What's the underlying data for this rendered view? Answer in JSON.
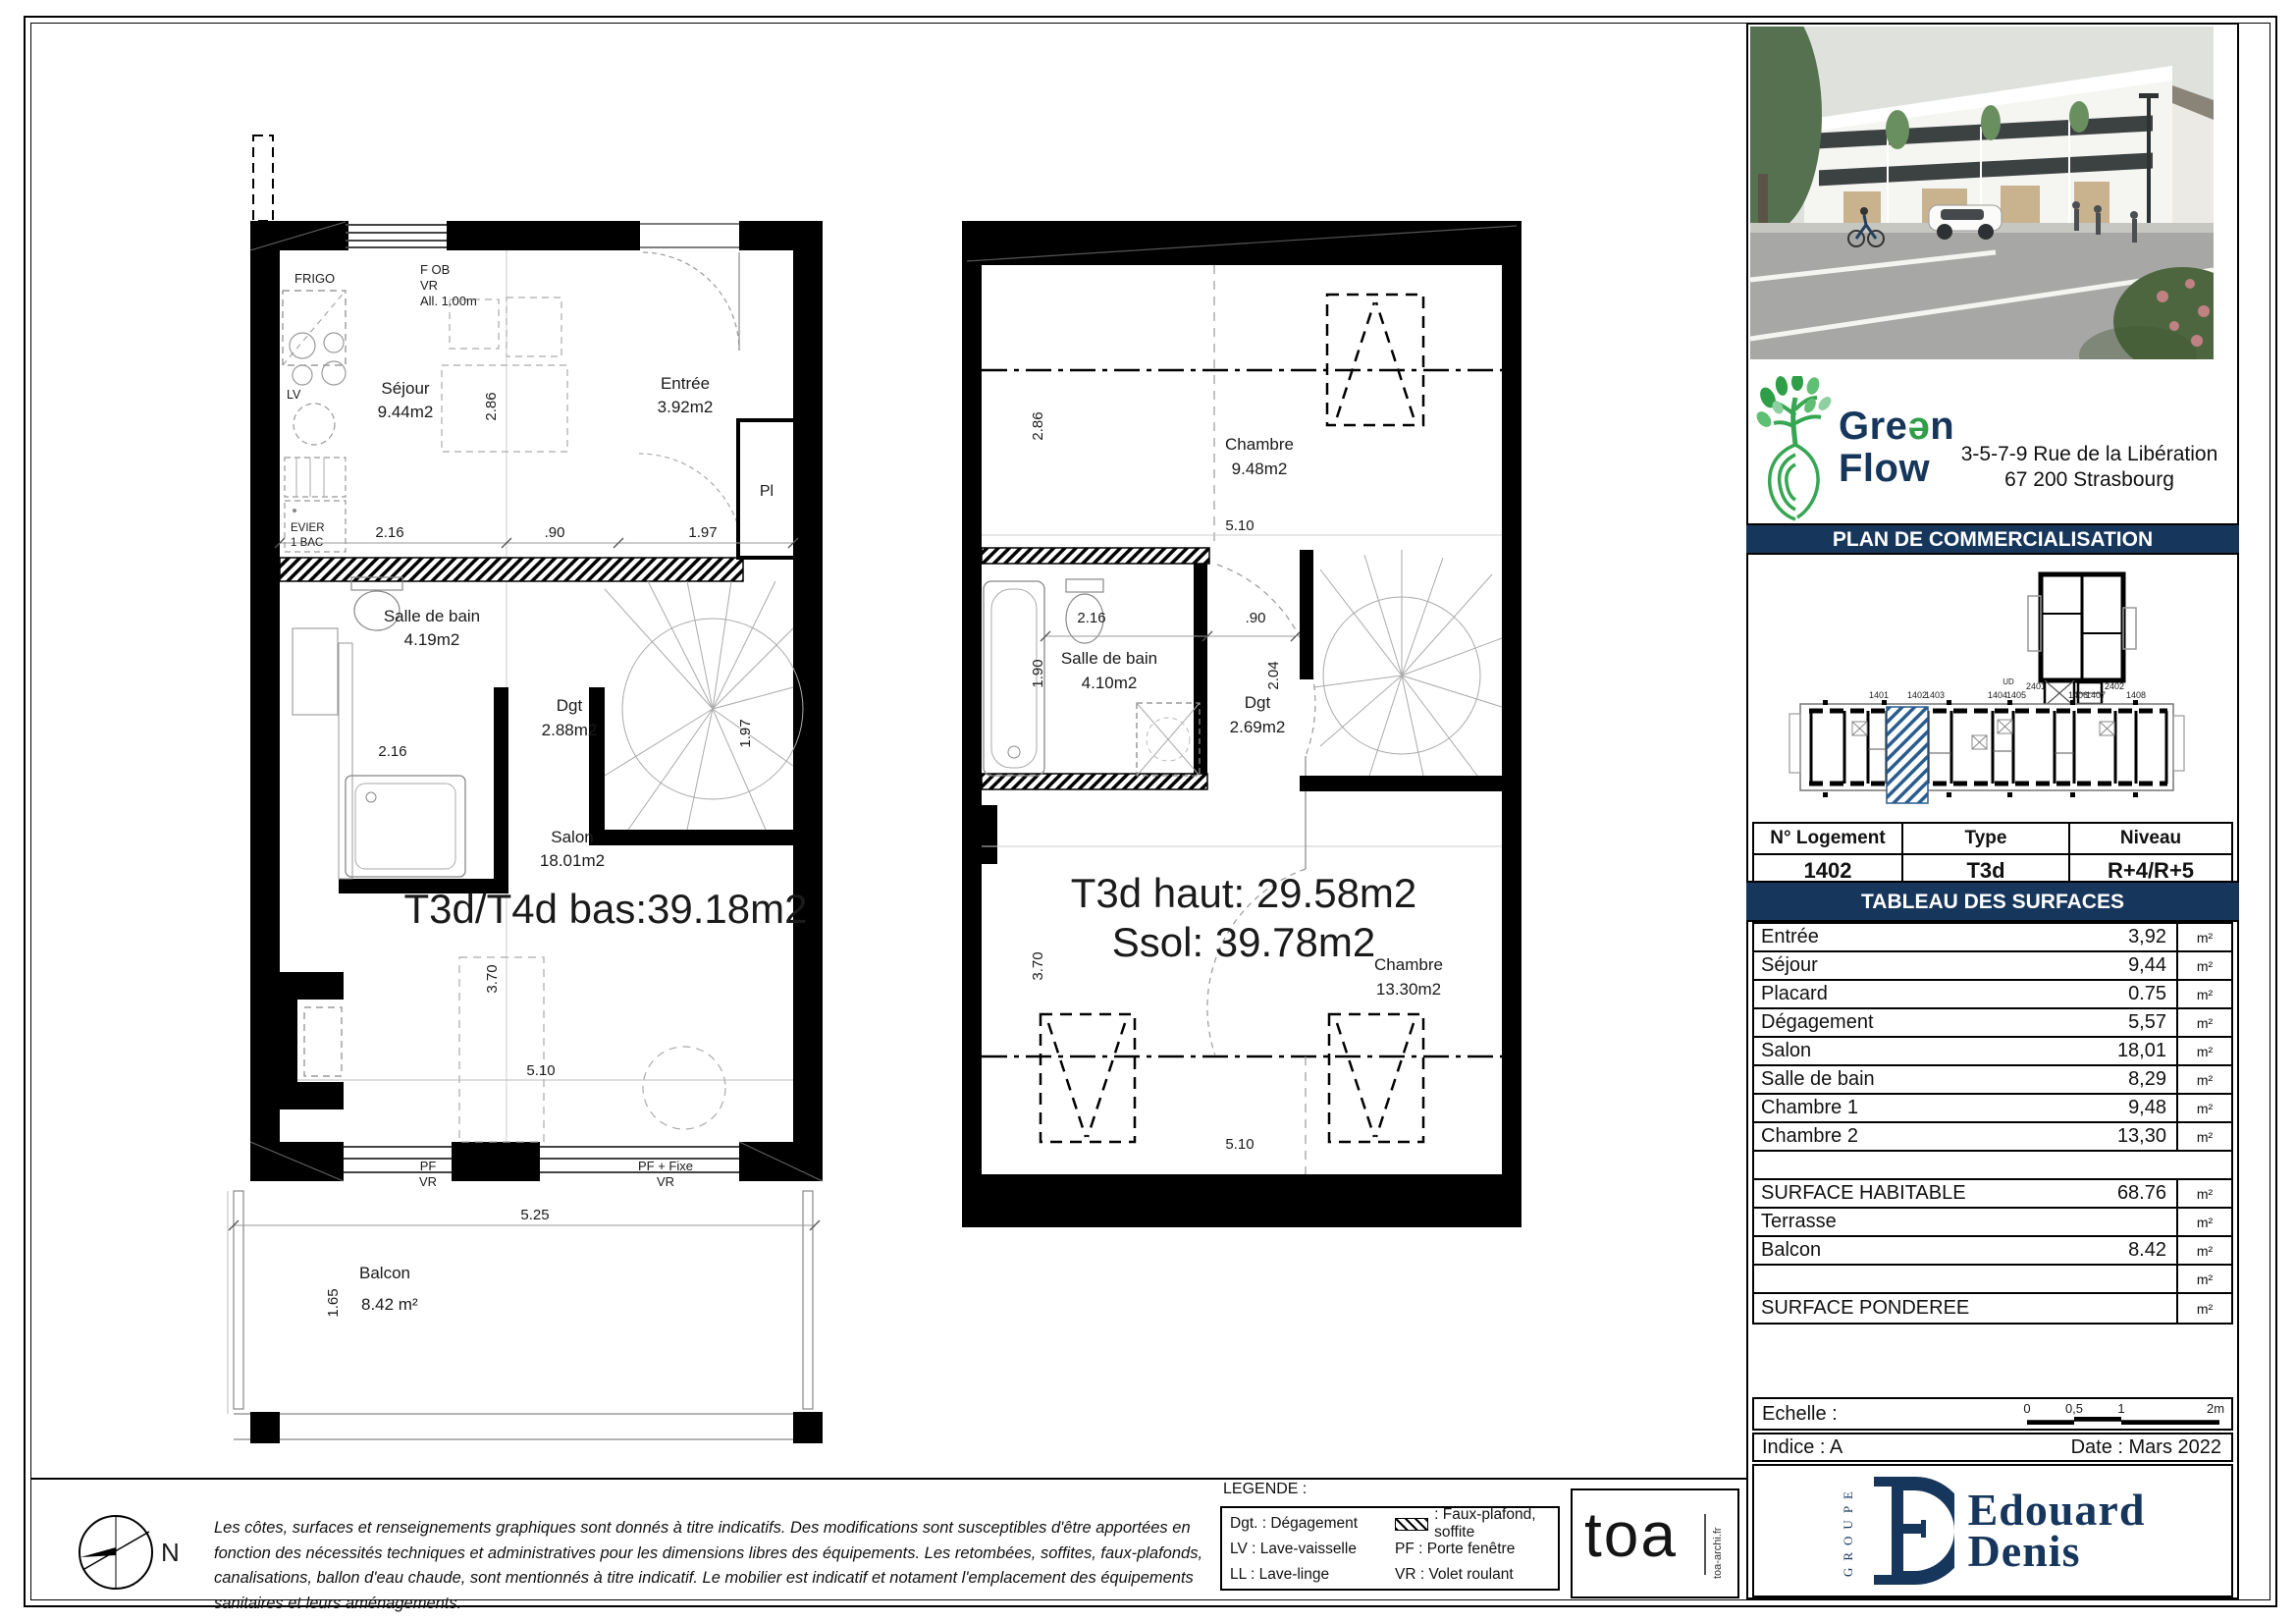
{
  "page": {
    "title": "PLAN DE COMMERCIALISATION"
  },
  "plans": {
    "left": {
      "title": "T3d/T4d bas:39.18m2",
      "labels": {
        "frigo": "FRIGO",
        "fob1": "F OB",
        "fob2": "VR",
        "fob3": "All. 1.00m",
        "sejour": "Séjour",
        "sejour_area": "9.44m2",
        "entree": "Entrée",
        "entree_area": "3.92m2",
        "pl": "Pl",
        "lv": "LV",
        "evier1": "EVIER",
        "evier2": "1 BAC",
        "sdb": "Salle de bain",
        "sdb_area": "4.19m2",
        "dgt": "Dgt",
        "dgt_area": "2.88m2",
        "salon": "Salon",
        "salon_area": "18.01m2",
        "pf1": "PF",
        "pf2": "VR",
        "pffixe1": "PF + Fixe",
        "pffixe2": "VR",
        "balcon": "Balcon",
        "balcon_area": "8.42 m²"
      },
      "dims": {
        "d286": "2.86",
        "d216a": "2.16",
        "d90": ".90",
        "d197a": "1.97",
        "d197b": "1.97",
        "d216b": "2.16",
        "d370": "3.70",
        "d510": "5.10",
        "d525": "5.25",
        "d165": "1.65"
      }
    },
    "right": {
      "title1": "T3d haut: 29.58m2",
      "title2": "Ssol: 39.78m2",
      "labels": {
        "chambre1": "Chambre",
        "chambre1_area": "9.48m2",
        "sdb": "Salle de bain",
        "sdb_area": "4.10m2",
        "dgt": "Dgt",
        "dgt_area": "2.69m2",
        "chambre2": "Chambre",
        "chambre2_area": "13.30m2"
      },
      "dims": {
        "d286": "2.86",
        "d510a": "5.10",
        "d216": "2.16",
        "d90": ".90",
        "d190": "1.90",
        "d204": "2.04",
        "d370": "3.70",
        "d510b": "5.10"
      }
    }
  },
  "sidebar": {
    "brand": {
      "p1": "Gre",
      "e": "ə",
      "p2": "n",
      "line2": "Flow"
    },
    "address_line1": "3-5-7-9 Rue de la Libération",
    "address_line2": "67 200 Strasbourg",
    "band_title": "PLAN DE COMMERCIALISATION",
    "key_plan": {
      "units": [
        "1401",
        "1402",
        "1403",
        "1404",
        "1405",
        "1406",
        "1407",
        "1408"
      ],
      "upper_units": [
        "2401",
        "2402"
      ],
      "entry": "UD"
    },
    "logement": {
      "headers": [
        "N° Logement",
        "Type",
        "Niveau"
      ],
      "values": [
        "1402",
        "T3d",
        "R+4/R+5"
      ]
    },
    "surfaces_title": "TABLEAU DES SURFACES",
    "rows": [
      {
        "label": "Entrée",
        "value": "3,92",
        "unit": "m²"
      },
      {
        "label": "Séjour",
        "value": "9,44",
        "unit": "m²"
      },
      {
        "label": "Placard",
        "value": "0.75",
        "unit": "m²"
      },
      {
        "label": "Dégagement",
        "value": "5,57",
        "unit": "m²"
      },
      {
        "label": "Salon",
        "value": "18,01",
        "unit": "m²"
      },
      {
        "label": "Salle de bain",
        "value": "8,29",
        "unit": "m²"
      },
      {
        "label": "Chambre 1",
        "value": "9,48",
        "unit": "m²"
      },
      {
        "label": "Chambre 2",
        "value": "13,30",
        "unit": "m²"
      }
    ],
    "summary": [
      {
        "label": "SURFACE HABITABLE",
        "value": "68.76",
        "unit": "m²"
      },
      {
        "label": "Terrasse",
        "value": "",
        "unit": "m²"
      },
      {
        "label": "Balcon",
        "value": "8.42",
        "unit": "m²"
      },
      {
        "label": "",
        "value": "",
        "unit": "m²"
      },
      {
        "label": "SURFACE PONDEREE",
        "value": "",
        "unit": "m²"
      }
    ],
    "echelle_label": "Echelle :",
    "scale_ticks": [
      "0",
      "0,5",
      "1",
      "2m"
    ],
    "indice": "Indice : A",
    "date": "Date : Mars 2022",
    "groupe": "GROUPE",
    "ed_line1": "Edouard",
    "ed_line2": "Denis"
  },
  "footer": {
    "north": "N",
    "disclaimer": "Les côtes, surfaces et renseignements graphiques sont donnés à titre indicatifs. Des modifications sont susceptibles d'être apportées en fonction des nécessités techniques et administratives pour les dimensions libres des équipements. Les retombées, soffites, faux-plafonds, canalisations, ballon d'eau chaude, sont mentionnés à titre indicatif. Le mobilier est indicatif et notament l'emplacement des équipements sanitaires et leurs aménagements.",
    "legende_title": "LEGENDE :",
    "legend": [
      {
        "c1": "Dgt. : Dégagement",
        "c2": ": Faux-plafond, soffite",
        "swatch": true
      },
      {
        "c1": "LV : Lave-vaisselle",
        "c2": "PF : Porte fenêtre",
        "swatch": false
      },
      {
        "c1": "LL : Lave-linge",
        "c2": "VR : Volet roulant",
        "swatch": false
      }
    ],
    "toa": "toa",
    "toa_sub": "toa-archi.fr"
  }
}
